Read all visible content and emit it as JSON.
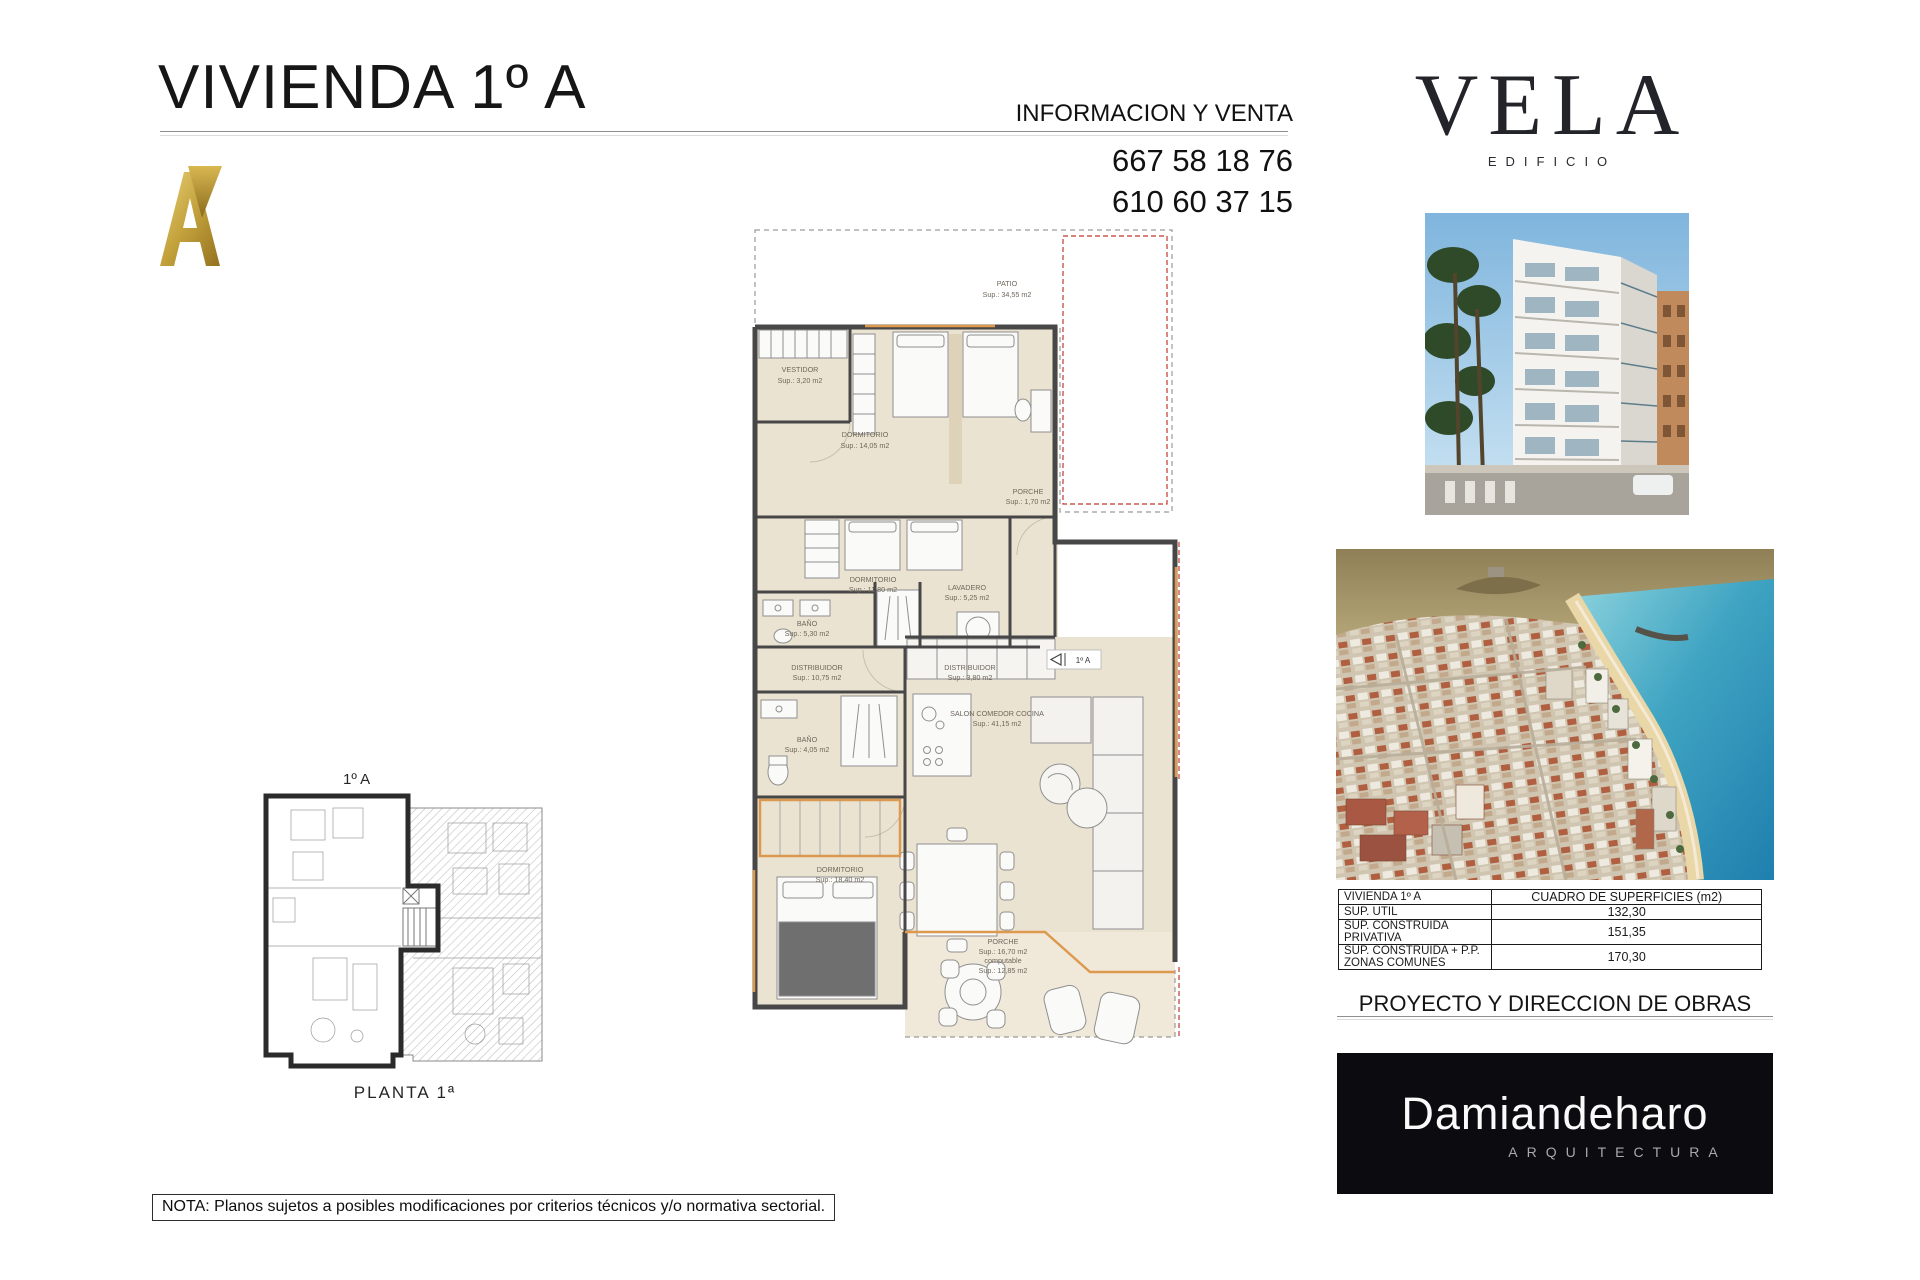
{
  "header": {
    "title": "VIVIENDA 1º A",
    "info_label": "INFORMACION Y VENTA",
    "phone1": "667 58 18 76",
    "phone2": "610 60 37 15"
  },
  "brand": {
    "name": "VELA",
    "subtitle": "EDIFICIO"
  },
  "floorplan": {
    "entrance_tag": "1º A",
    "rooms": [
      {
        "name": "PATIO",
        "sup": "Sup.: 34,55 m2"
      },
      {
        "name": "VESTIDOR",
        "sup": "Sup.: 3,20 m2"
      },
      {
        "name": "DORMITORIO",
        "sup": "Sup.: 14,05 m2"
      },
      {
        "name": "PORCHE",
        "sup": "Sup.: 1,70 m2"
      },
      {
        "name": "DORMITORIO",
        "sup": "Sup.: 11,80 m2"
      },
      {
        "name": "BAÑO",
        "sup": "Sup.: 5,30 m2"
      },
      {
        "name": "LAVADERO",
        "sup": "Sup.: 5,25 m2"
      },
      {
        "name": "DISTRIBUIDOR",
        "sup": "Sup.: 10,75 m2"
      },
      {
        "name": "DISTRIBUIDOR",
        "sup": "Sup.: 3,80 m2"
      },
      {
        "name": "BAÑO",
        "sup": "Sup.: 4,05 m2"
      },
      {
        "name": "DORMITORIO",
        "sup": "Sup.: 18,40 m2"
      },
      {
        "name": "SALON COMEDOR COCINA",
        "sup": "Sup.: 41,15 m2"
      },
      {
        "name": "PORCHE",
        "sup": "Sup.: 16,70 m2",
        "sup2_label": "computable",
        "sup2": "Sup.: 12,85 m2"
      }
    ]
  },
  "keyplan": {
    "unit_label": "1º A",
    "caption": "PLANTA 1ª"
  },
  "surfaces_table": {
    "unit": "VIVIENDA 1º A",
    "header": "CUADRO DE SUPERFICIES (m2)",
    "rows": [
      {
        "label": "SUP. UTIL",
        "value": "132,30"
      },
      {
        "label": "SUP. CONSTRUIDA PRIVATIVA",
        "value": "151,35"
      },
      {
        "label": "SUP. CONSTRUIDA + P.P. ZONAS COMUNES",
        "value": "170,30"
      }
    ]
  },
  "project": {
    "heading": "PROYECTO Y DIRECCION DE OBRAS",
    "studio": "Damiandeharo",
    "studio_sub": "ARQUITECTURA"
  },
  "note": "NOTA: Planos sujetos a posibles modificaciones por criterios técnicos y/o normativa sectorial.",
  "colors": {
    "gold": "#c3a23c",
    "wall": "#474747",
    "floor": "#ebe3d1",
    "accent_orange": "#dd9a4e",
    "boundary_red": "#c0392b"
  }
}
